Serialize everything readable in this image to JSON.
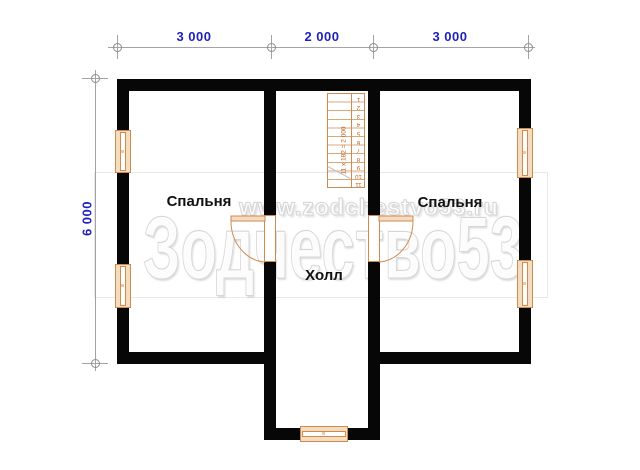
{
  "dimensions": {
    "top": [
      "3 000",
      "2 000",
      "3 000"
    ],
    "left": "6 000"
  },
  "rooms": {
    "bedroom_left": {
      "label": "Спальня"
    },
    "bedroom_right": {
      "label": "Спальня"
    },
    "hall": {
      "label": "Холл"
    }
  },
  "stairs": {
    "steps": [
      "1",
      "2",
      "3",
      "4",
      "5",
      "6",
      "7",
      "8",
      "9",
      "10",
      "11"
    ],
    "annotation": "11 х 182 = 2 000"
  },
  "watermark": {
    "url": "www.zodchestvo53.ru",
    "brand": "Зодчество53"
  },
  "colors": {
    "wall": "#070707",
    "joinery_accent": "#cf8a50",
    "joinery_fill": "#f4dcbe",
    "dimension_text": "#2222bb",
    "dimension_line": "#a3a3a3",
    "watermark_gray": "#d6d6d6",
    "background": "#ffffff"
  }
}
